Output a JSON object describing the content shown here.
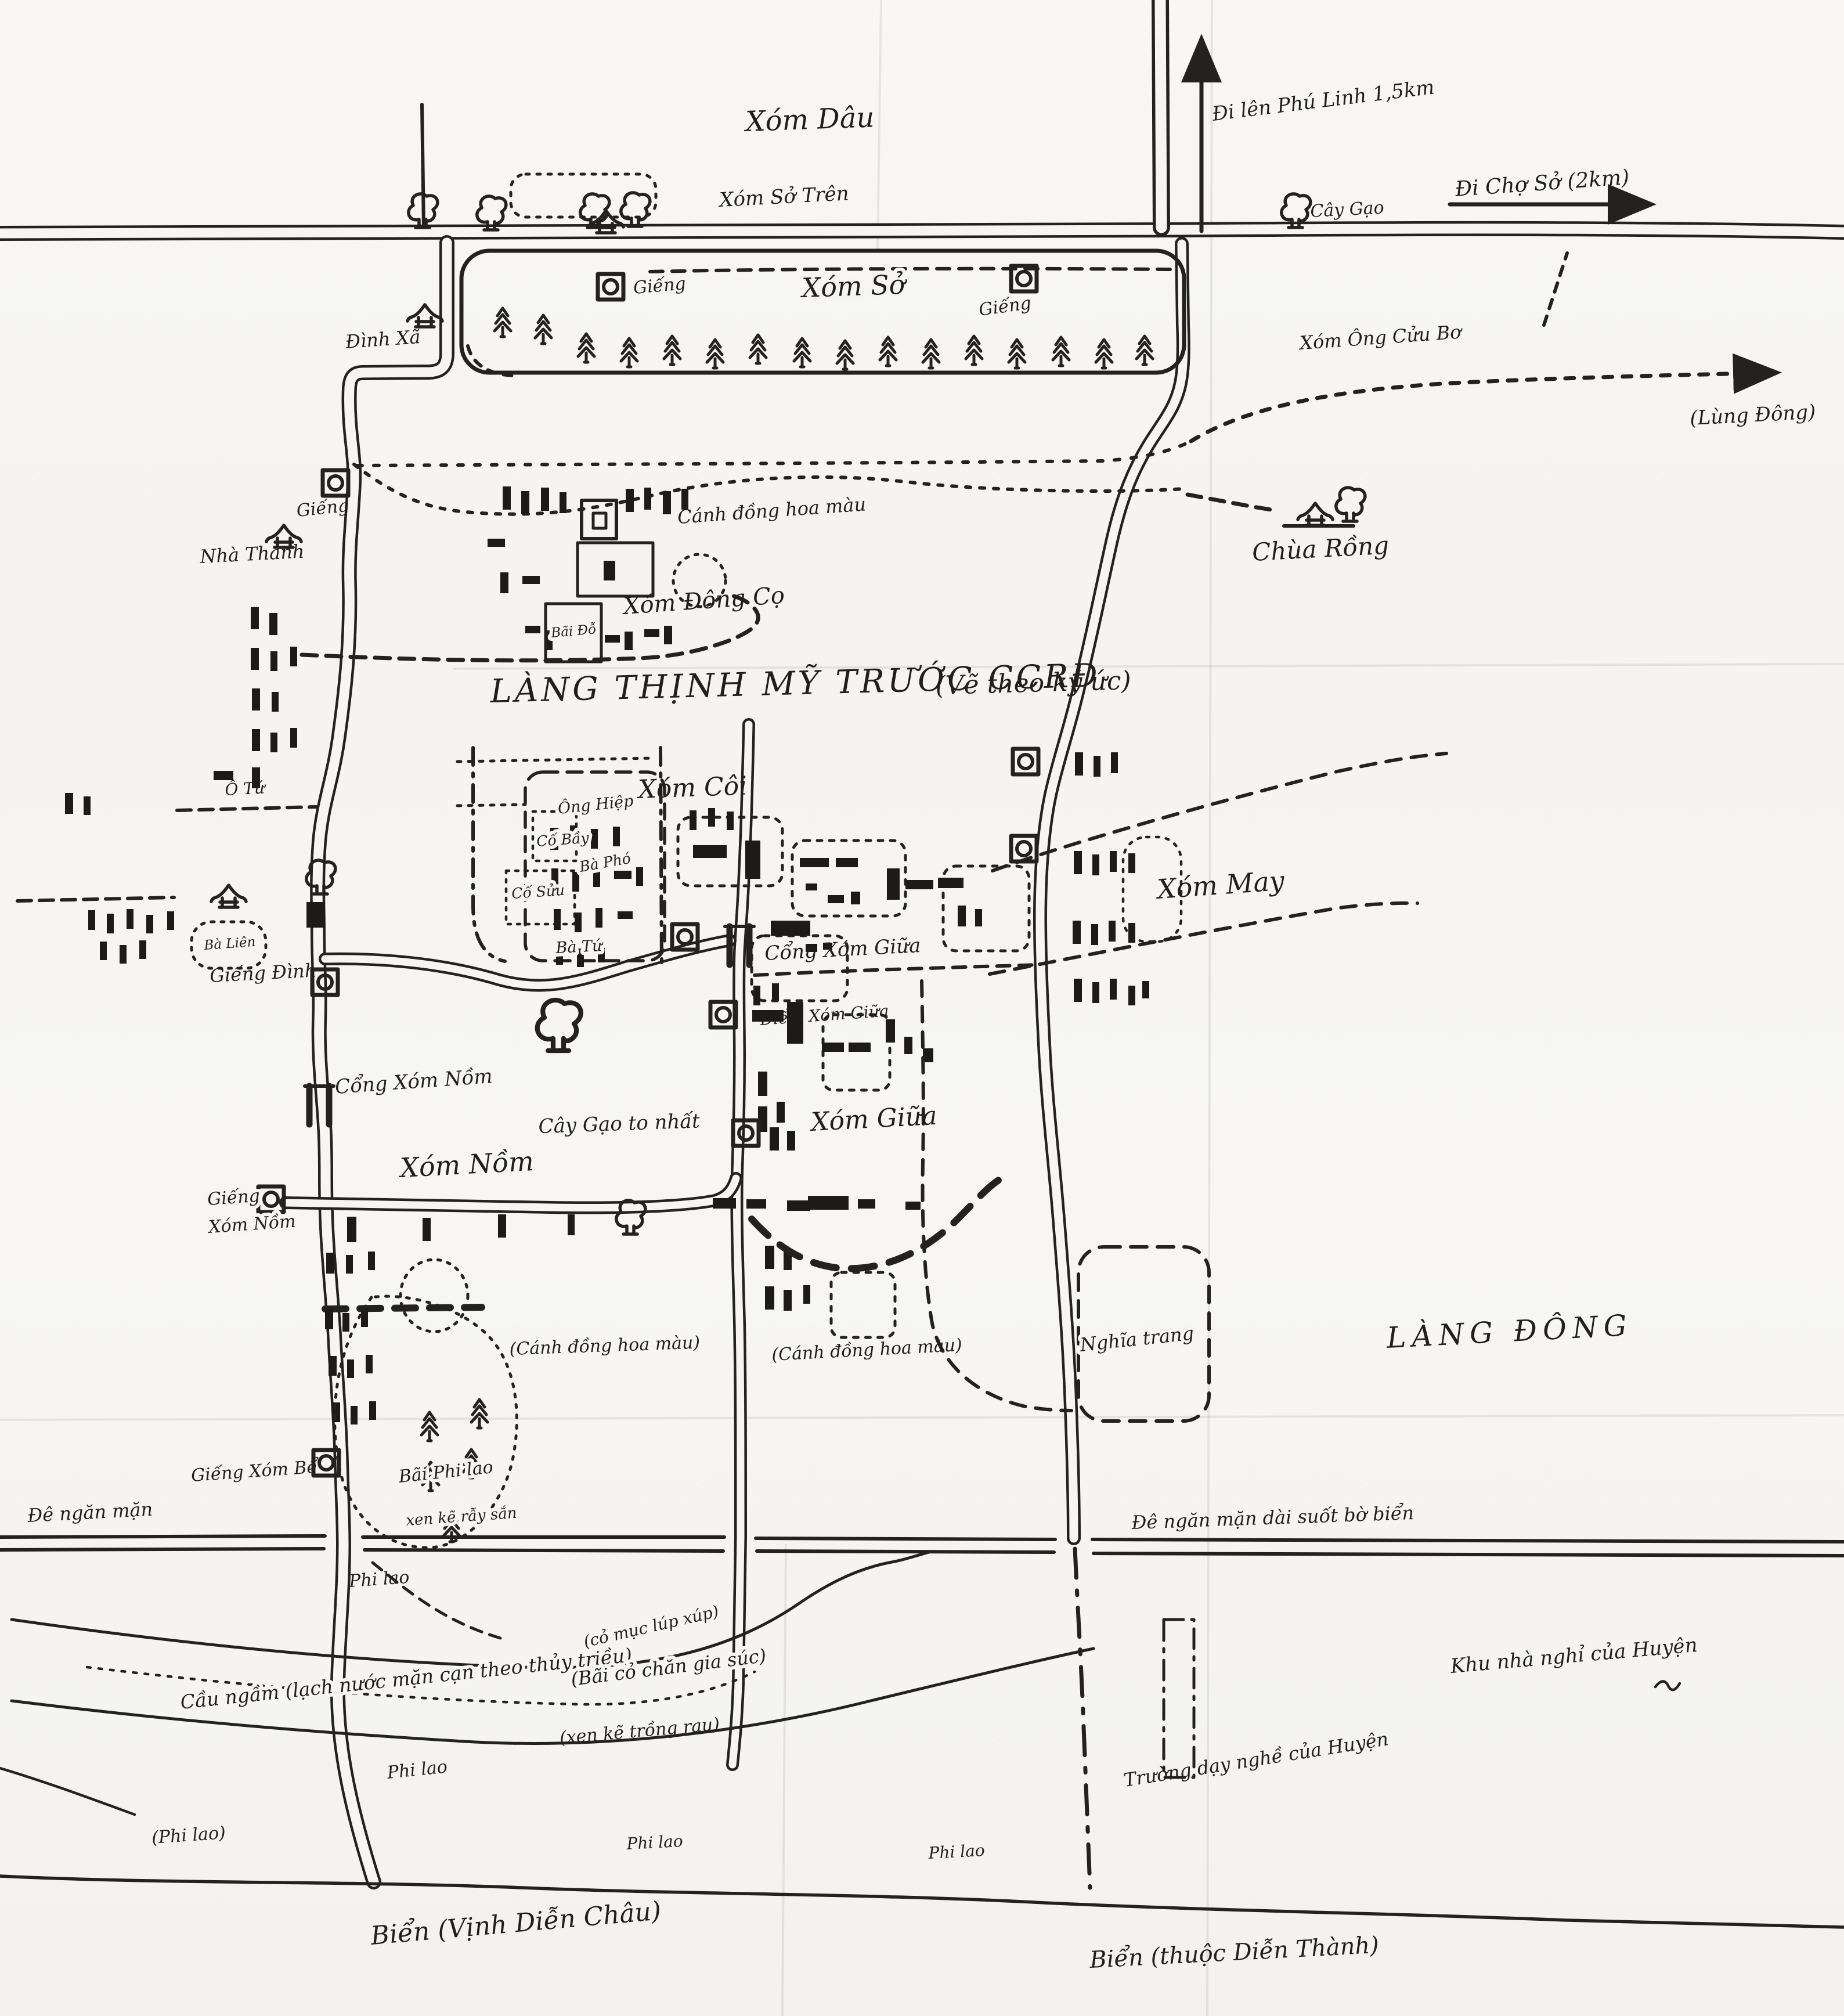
{
  "map": {
    "title_main": "LÀNG THỊNH MỸ TRƯỚC CCRĐ",
    "title_note": "(Vẽ theo ký ức)"
  },
  "colors": {
    "ink": "#24221f",
    "paper": "#f6f5f1"
  },
  "labels": {
    "xom_dau": "Xóm Dâu",
    "xom_so_tren": "Xóm Sở Trên",
    "di_len_phu_linh": "Đi lên Phú Linh 1,5km",
    "cay_gao_top": "Cây Gạo",
    "di_cho_so": "Đi Chợ Sở (2km)",
    "xom_so": "Xóm Sở",
    "gieng_band_1": "Giếng",
    "gieng_band_2": "Giếng",
    "dinh_xa": "Đình Xã",
    "xom_ong_cuu_bo": "Xóm Ông Cửu Bơ",
    "lung_dong": "(Lùng Đông)",
    "chua_rong": "Chùa Rồng",
    "gieng_tay": "Giếng",
    "nha_thanh": "Nhà Thánh",
    "canh_dong_hoa_mau_1": "Cánh đồng hoa màu",
    "xom_dong_co": "Xóm Đông Cọ",
    "bai_do": "Bãi Đỗ",
    "o_tu": "Ô Tứ",
    "xom_coi": "Xóm Côi",
    "ong_hiep": "Ông Hiệp",
    "co_bay": "Cố Bầy",
    "ba_pho": "Bà Phó",
    "co_suu": "Cố Sửu",
    "ba_tu": "Bà Tứ",
    "ba_lien": "Bà Liên",
    "gieng_dinh": "Giếng Đình",
    "cong_xom_giua": "Cổng Xóm Giữa",
    "diem_xom_giua": "Điểm Xóm Giữa",
    "cay_gao_to_nhat": "Cây Gạo to nhất",
    "xom_giua": "Xóm Giữa",
    "xom_may": "Xóm May",
    "cong_xom_nom": "Cổng Xóm Nồm",
    "xom_nom": "Xóm Nồm",
    "gieng_xom_nom_1": "Giếng",
    "gieng_xom_nom_2": "Xóm Nồm",
    "canh_dong_hoa_mau_2": "(Cánh đồng hoa màu)",
    "canh_dong_hoa_mau_3": "(Cánh đồng hoa màu)",
    "nghia_trang": "Nghĩa trang",
    "lang_dong": "LÀNG ĐÔNG",
    "gieng_xom_be": "Giếng Xóm Bể",
    "bai_phi_lao": "Bãi Phi lao",
    "xen_ke_ray_san": "xen kẽ rẫy sắn",
    "de_ngan_man": "Đê ngăn mặn",
    "de_ngan_man_dai": "Đê ngăn mặn dài suốt bờ biển",
    "phi_lao_1": "Phi lao",
    "cau_ngam": "Cầu ngầm (lạch nước mặn cạn theo thủy triều)",
    "co_muc": "(cỏ mục lúp xúp)",
    "bai_co_chan": "(Bãi cỏ chăn gia súc)",
    "xen_ke_trong_rau": "(xen kẽ trồng rau)",
    "phi_lao_2": "Phi lao",
    "phi_lao_3": "(Phi lao)",
    "phi_lao_4": "Phi lao",
    "phi_lao_5": "Phi lao",
    "khu_nha_nghi": "Khu nhà nghỉ của Huyện",
    "truong_day_nghe": "Trường dạy nghề của Huyện",
    "bien_vinh": "Biển (Vịnh Diễn Châu)",
    "bien_thuoc": "Biển (thuộc Diễn Thành)"
  }
}
